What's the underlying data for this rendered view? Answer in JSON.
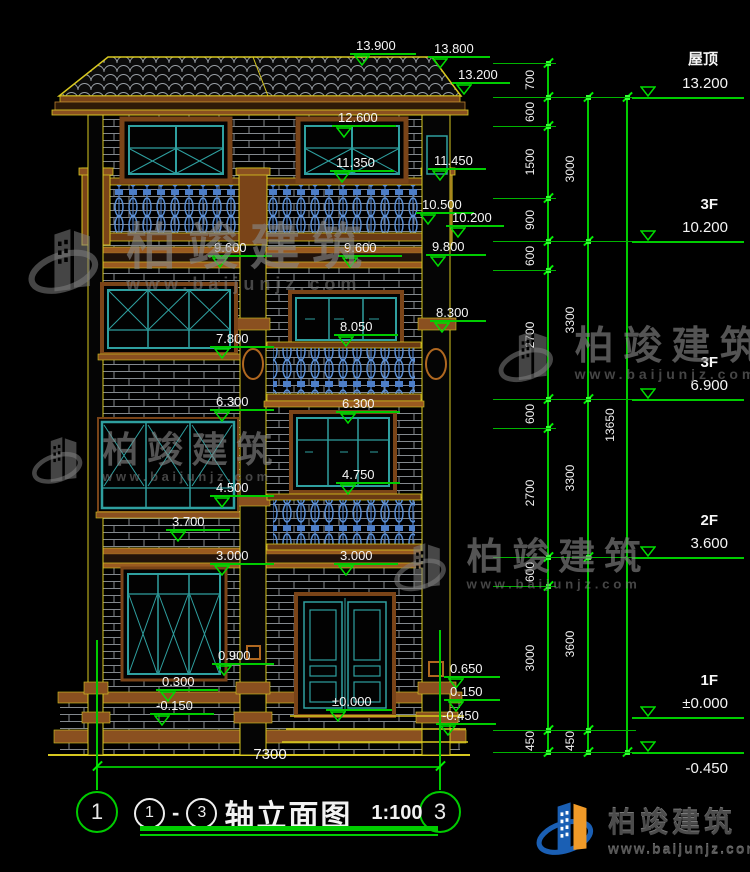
{
  "drawing": {
    "type": "building-front-elevation",
    "scale_note": "1:100"
  },
  "footer": {
    "axis_start": "1",
    "axis_end": "3",
    "dash": "-",
    "title": "轴立面图",
    "scale": "1:100",
    "overall_width": "7300"
  },
  "logo": {
    "brand": "柏竣建筑",
    "site": "www.baijunjz.com"
  },
  "watermark": {
    "brand": "柏竣建筑",
    "site": "www.baijunjz.com",
    "instances": [
      {
        "x": 20,
        "y": 222,
        "s": 1.0
      },
      {
        "x": 492,
        "y": 326,
        "s": 0.78
      },
      {
        "x": 26,
        "y": 432,
        "s": 0.72
      },
      {
        "x": 388,
        "y": 538,
        "s": 0.74
      }
    ]
  },
  "right_panel": {
    "levels": [
      {
        "label": "屋顶",
        "value": "13.200",
        "y": 97,
        "below": false
      },
      {
        "label": "3F",
        "value": "10.200",
        "y": 241,
        "below": false
      },
      {
        "label": "3F",
        "value": "6.900",
        "y": 399,
        "below": false
      },
      {
        "label": "2F",
        "value": "3.600",
        "y": 557,
        "below": false
      },
      {
        "label": "1F",
        "value": "±0.000",
        "y": 717,
        "below": false
      },
      {
        "label": "",
        "value": "-0.450",
        "y": 752,
        "below": true
      }
    ],
    "chain1": {
      "x": 548,
      "label_x": 530,
      "segments": [
        {
          "v": "700",
          "y1": 63,
          "y2": 97
        },
        {
          "v": "600",
          "y1": 97,
          "y2": 126
        },
        {
          "v": "1500",
          "y1": 126,
          "y2": 198
        },
        {
          "v": "900",
          "y1": 198,
          "y2": 241
        },
        {
          "v": "600",
          "y1": 241,
          "y2": 270
        },
        {
          "v": "2700",
          "y1": 270,
          "y2": 399
        },
        {
          "v": "600",
          "y1": 399,
          "y2": 428
        },
        {
          "v": "2700",
          "y1": 428,
          "y2": 557
        },
        {
          "v": "600",
          "y1": 557,
          "y2": 586
        },
        {
          "v": "3000",
          "y1": 586,
          "y2": 730
        },
        {
          "v": "450",
          "y1": 730,
          "y2": 752
        }
      ]
    },
    "chain2": {
      "x": 588,
      "label_x": 570,
      "segments": [
        {
          "v": "3000",
          "y1": 97,
          "y2": 241
        },
        {
          "v": "3300",
          "y1": 241,
          "y2": 399
        },
        {
          "v": "3300",
          "y1": 399,
          "y2": 557
        },
        {
          "v": "3600",
          "y1": 557,
          "y2": 730
        },
        {
          "v": "450",
          "y1": 730,
          "y2": 752
        }
      ]
    },
    "overall": {
      "x": 627,
      "label_x": 610,
      "v": "13650",
      "y1": 97,
      "y2": 752
    }
  },
  "elevation_marks": [
    {
      "v": "13.900",
      "x": 350,
      "y": 55,
      "w": 66
    },
    {
      "v": "13.800",
      "x": 428,
      "y": 58,
      "w": 62
    },
    {
      "v": "13.200",
      "x": 452,
      "y": 84,
      "w": 58
    },
    {
      "v": "12.600",
      "x": 332,
      "y": 127,
      "w": 64
    },
    {
      "v": "11.350",
      "x": 330,
      "y": 172,
      "w": 64
    },
    {
      "v": "11.450",
      "x": 428,
      "y": 170,
      "w": 58
    },
    {
      "v": "10.500",
      "x": 416,
      "y": 214,
      "w": 58
    },
    {
      "v": "10.200",
      "x": 446,
      "y": 227,
      "w": 58
    },
    {
      "v": "9.800",
      "x": 426,
      "y": 256,
      "w": 60
    },
    {
      "v": "9.600",
      "x": 208,
      "y": 257,
      "w": 64
    },
    {
      "v": "9.600",
      "x": 338,
      "y": 257,
      "w": 64
    },
    {
      "v": "8.300",
      "x": 430,
      "y": 322,
      "w": 56
    },
    {
      "v": "8.050",
      "x": 334,
      "y": 336,
      "w": 64
    },
    {
      "v": "7.800",
      "x": 210,
      "y": 348,
      "w": 64
    },
    {
      "v": "6.300",
      "x": 210,
      "y": 411,
      "w": 64
    },
    {
      "v": "6.300",
      "x": 336,
      "y": 413,
      "w": 64
    },
    {
      "v": "4.750",
      "x": 336,
      "y": 484,
      "w": 64
    },
    {
      "v": "4.500",
      "x": 210,
      "y": 497,
      "w": 64
    },
    {
      "v": "3.700",
      "x": 166,
      "y": 531,
      "w": 64
    },
    {
      "v": "3.000",
      "x": 210,
      "y": 565,
      "w": 64
    },
    {
      "v": "3.000",
      "x": 334,
      "y": 565,
      "w": 64
    },
    {
      "v": "0.900",
      "x": 212,
      "y": 665,
      "w": 62
    },
    {
      "v": "0.300",
      "x": 156,
      "y": 691,
      "w": 62
    },
    {
      "v": "-0.150",
      "x": 150,
      "y": 715,
      "w": 64
    },
    {
      "v": "±0.000",
      "x": 326,
      "y": 711,
      "w": 66
    },
    {
      "v": "0.650",
      "x": 444,
      "y": 678,
      "w": 56
    },
    {
      "v": "0.150",
      "x": 444,
      "y": 701,
      "w": 56
    },
    {
      "v": "-0.450",
      "x": 436,
      "y": 725,
      "w": 60
    }
  ]
}
